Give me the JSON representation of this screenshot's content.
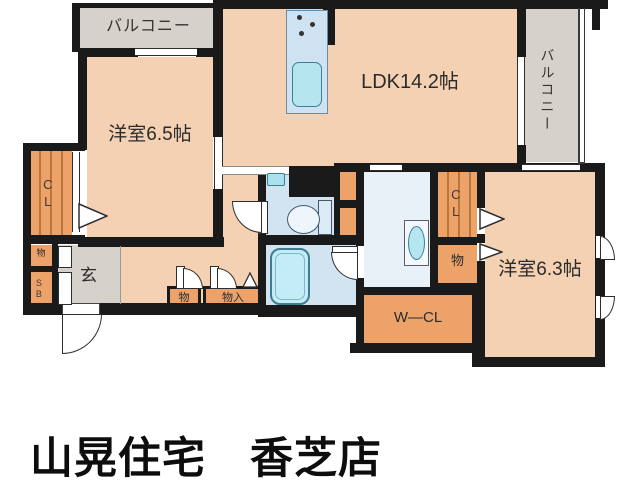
{
  "footer": {
    "title": "山晃住宅　香芝店"
  },
  "rooms": {
    "balcony_left": {
      "label": "バルコニー"
    },
    "balcony_right": {
      "label": "バルコニー"
    },
    "ldk": {
      "label": "LDK14.2帖"
    },
    "bedroom_65": {
      "label": "洋室6.5帖"
    },
    "bedroom_63": {
      "label": "洋室6.3帖"
    },
    "entrance": {
      "label": "玄"
    },
    "walk_in_closet": {
      "label": "W―CL"
    },
    "closet_left": {
      "label": "CL"
    },
    "closet_right": {
      "label": "CL"
    },
    "shoe_box": {
      "label": "SB"
    },
    "storage_left": {
      "label": "物"
    },
    "storage_hall": {
      "label": "物"
    },
    "storage_hall_closet": {
      "label": "物入"
    },
    "storage_right": {
      "label": "物"
    }
  },
  "colors": {
    "wall": "#1a1a1a",
    "room_fill": "#f3d1b2",
    "closet_fill": "#eca269",
    "balcony_fill": "#d6d2cb",
    "wet_area_fill": "#d2e4f2",
    "washroom_fill": "#e8f0f8",
    "fixture_cyan": "#b5e6f0",
    "text": "#2b2b2b"
  }
}
